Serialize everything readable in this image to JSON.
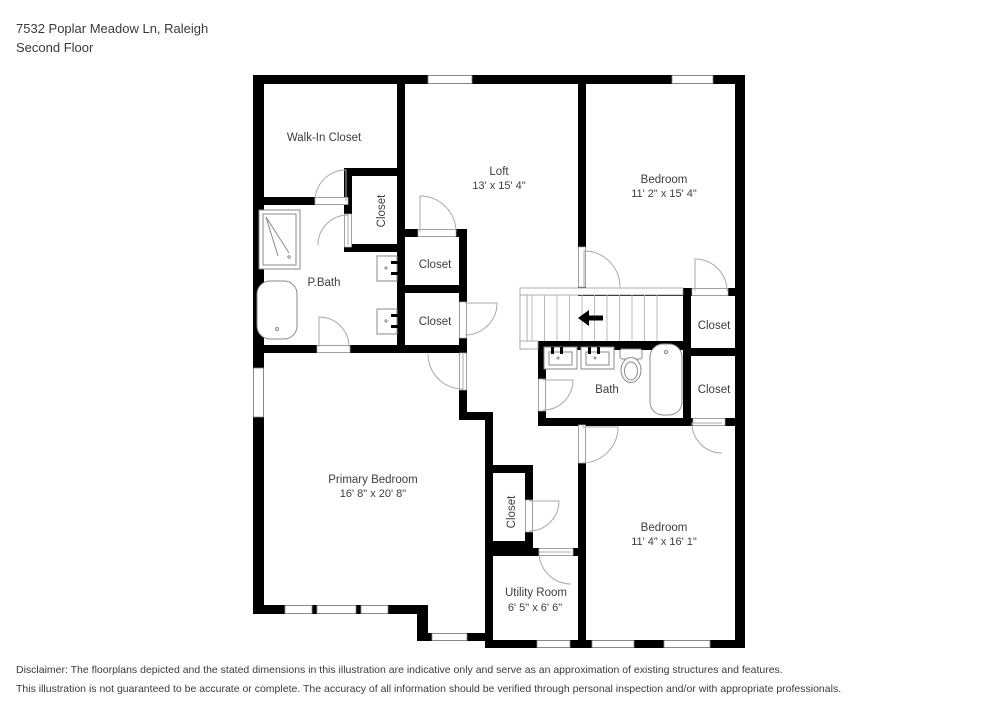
{
  "header": {
    "address": "7532 Poplar Meadow Ln, Raleigh",
    "floor": "Second Floor"
  },
  "rooms": {
    "walk_in_closet": {
      "name": "Walk-In Closet"
    },
    "loft": {
      "name": "Loft",
      "dims": "13' x 15' 4\""
    },
    "bedroom_tr": {
      "name": "Bedroom",
      "dims": "11' 2\" x 15' 4\""
    },
    "pbath": {
      "name": "P.Bath"
    },
    "bath": {
      "name": "Bath"
    },
    "primary": {
      "name": "Primary Bedroom",
      "dims": "16' 8\" x 20' 8\""
    },
    "bedroom_br": {
      "name": "Bedroom",
      "dims": "11' 4\" x 16' 1\""
    },
    "utility": {
      "name": "Utility Room",
      "dims": "6' 5\" x 6' 6\""
    },
    "closet": {
      "name": "Closet"
    }
  },
  "disclaimer": {
    "line1": "Disclaimer: The floorplans depicted and the stated dimensions in this illustration are indicative only and serve as an approximation of existing structures and features.",
    "line2": "This illustration is not guaranteed to be accurate or complete. The accuracy of all information should be verified through personal inspection and/or with appropriate professionals."
  },
  "colors": {
    "walls": "#000000",
    "text": "#3d3d3d",
    "fixtures": "#8a8a8a"
  }
}
